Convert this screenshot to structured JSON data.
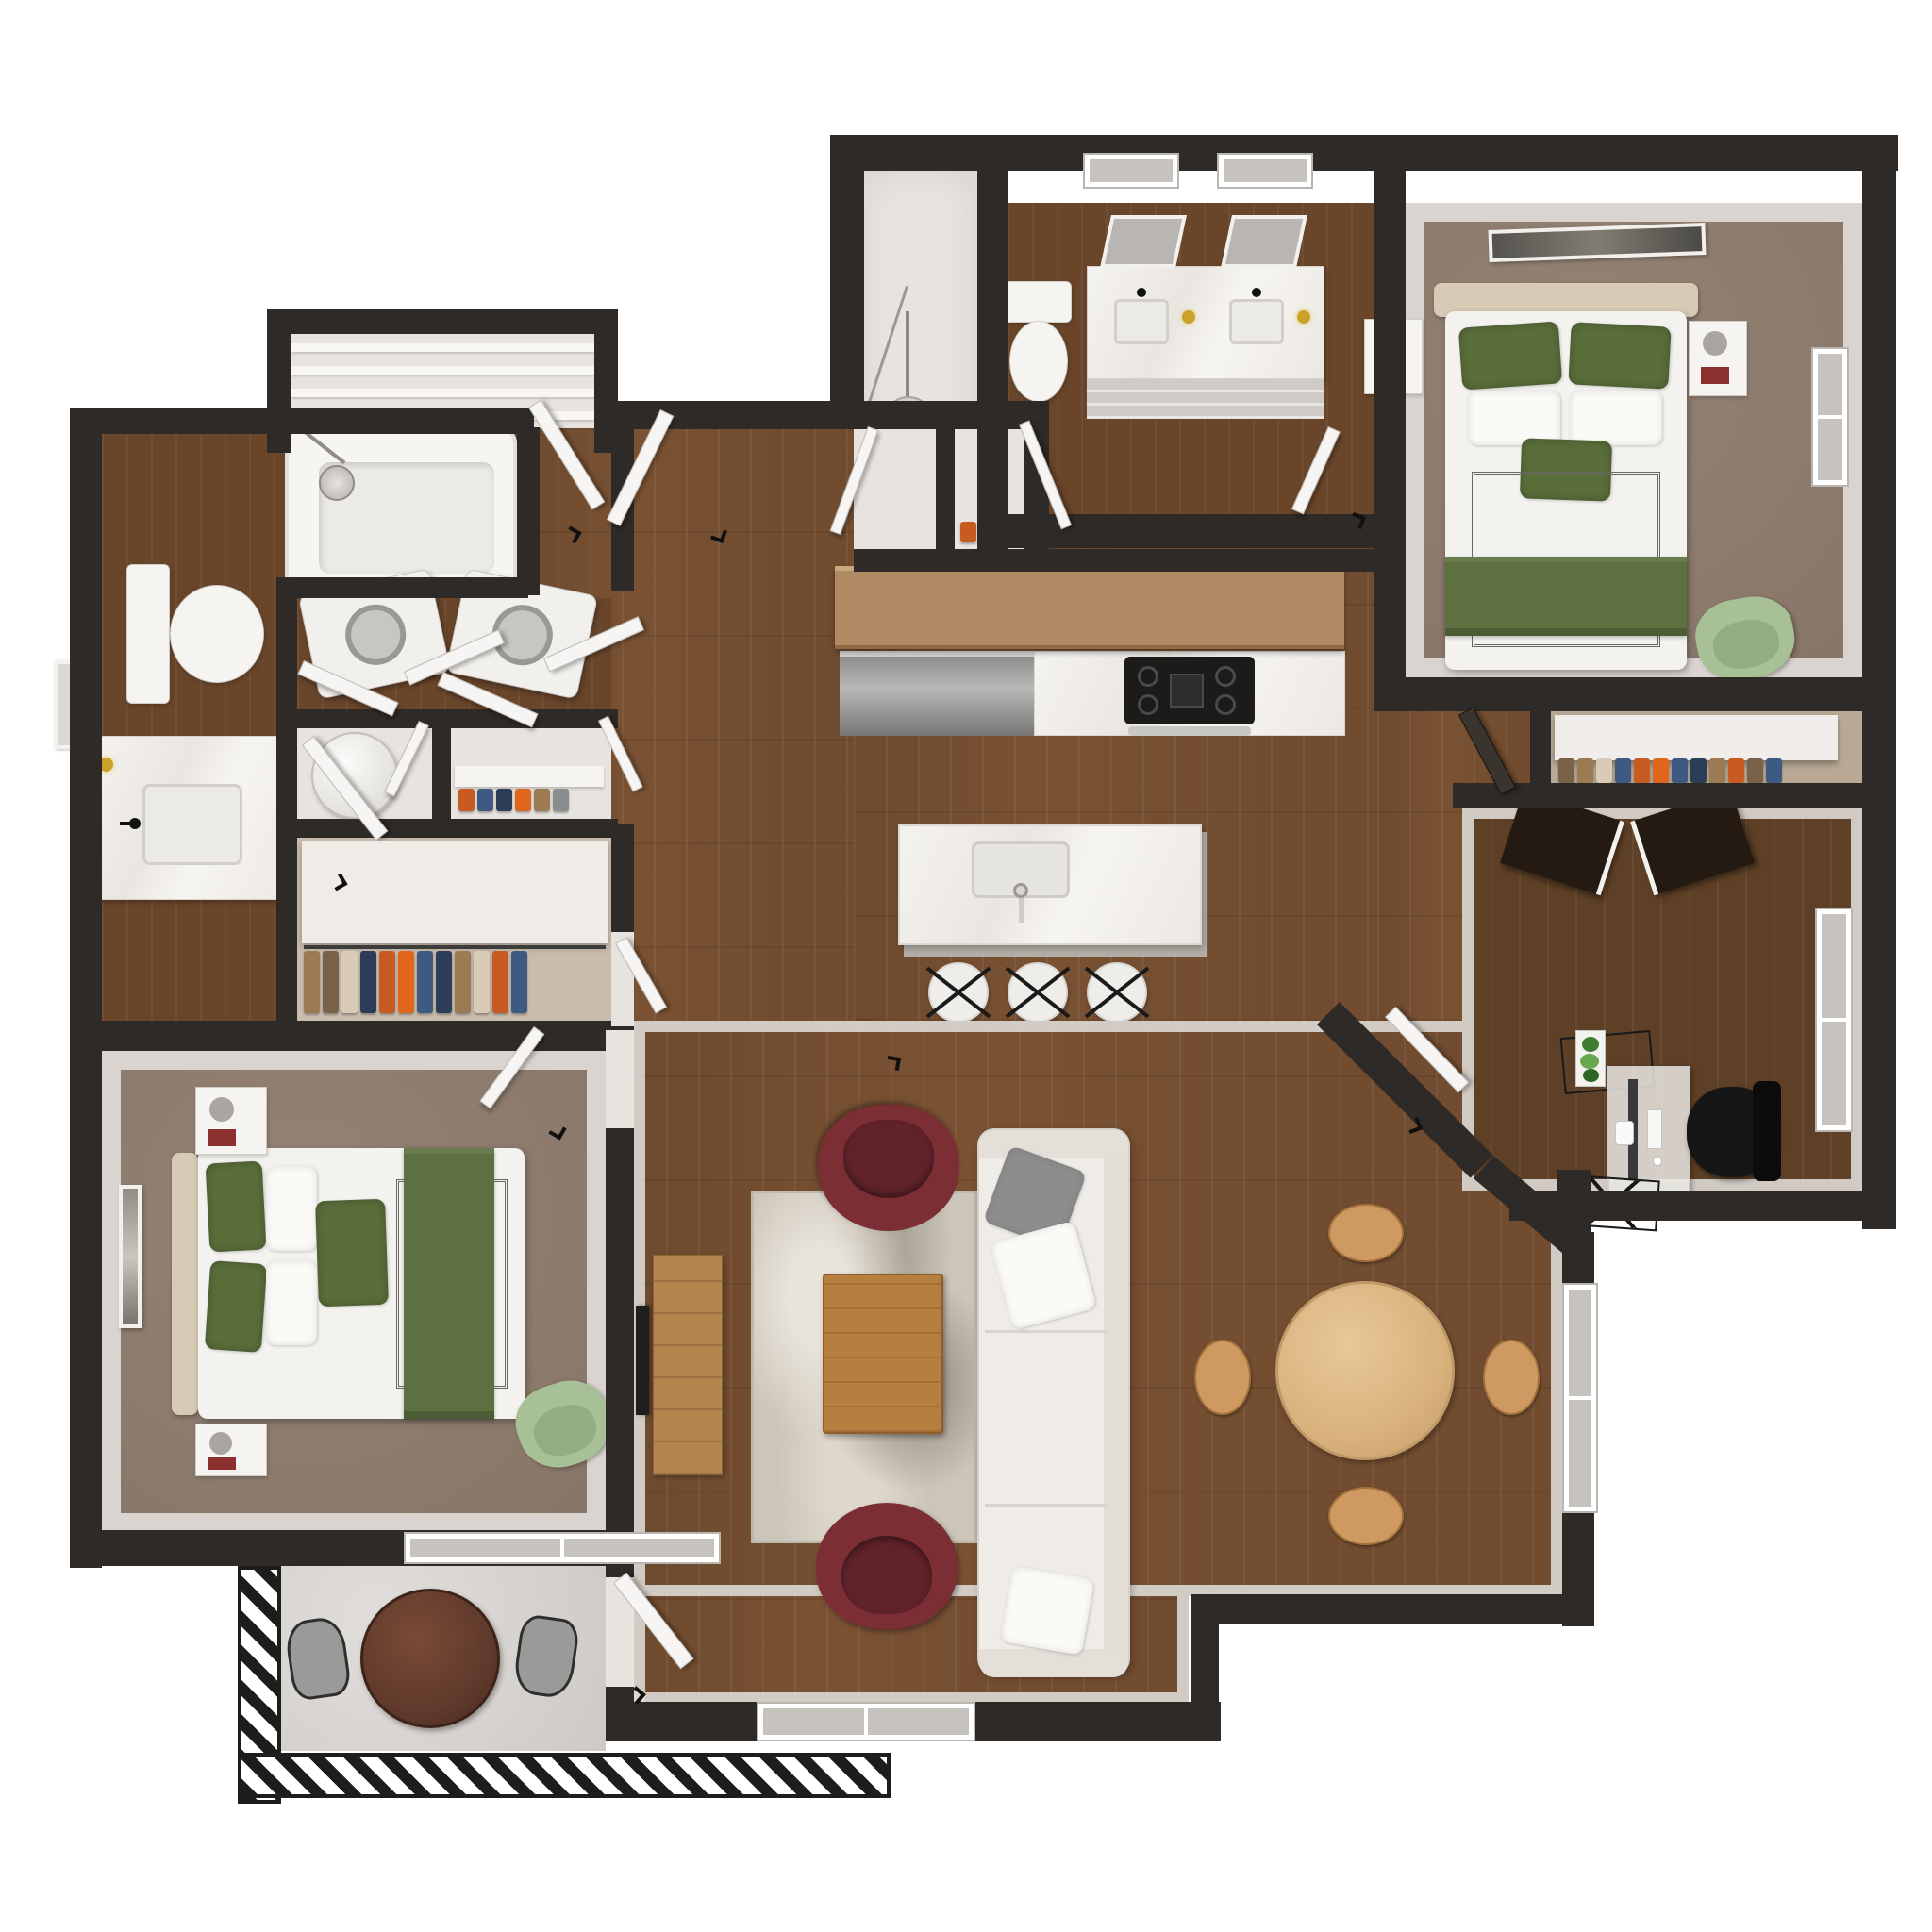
{
  "meta": {
    "title": "3D Apartment Floor Plan - Top-Down Render",
    "type": "floor-plan",
    "view": "top-down dollhouse",
    "style": "photorealistic 3D render, no text labels",
    "unit": "two-bedroom, two-bath apartment with den and balcony"
  },
  "colors": {
    "wall": "#2d2a27",
    "wood": "#7a5233",
    "wood_dark": "#69452a",
    "wood_office": "#5e4026",
    "carpet": "#8e7b6c",
    "carpet_light": "#c9bcae",
    "floor_light": "#e7e3df",
    "concrete": "#d6d2ce",
    "marble": "#f2efea",
    "green": "#5a6e3a",
    "green_throw": "#5d7140",
    "green_chair": "#a7c096",
    "burgundy": "#7b2e34",
    "rug": "#ccc5ba",
    "sofa": "#efece7",
    "bar_wood": "#b08a63",
    "table_wood": "#d9b27e",
    "chair_tan": "#cf9a62",
    "console_wood": "#b5854e",
    "coffee_wood": "#b77f3f",
    "walnut": "#5e392b",
    "clothes1": "#9c7b52",
    "clothes2": "#3f5a82",
    "clothes3": "#c75b22",
    "clothes4": "#2c3e57",
    "clothes5": "#7a6248",
    "clothes6": "#d9cbb8",
    "clothes7": "#e0661c",
    "clothes8": "#8a8d90"
  },
  "rooms": [
    {
      "id": "master-bedroom",
      "name": "Primary Bedroom",
      "floor": "taupe carpet",
      "furniture": [
        "upholstered bed with white duvet, green pillows and green throw",
        "two white nightstands with lamps and books",
        "sage green armchair",
        "framed art above bed",
        "window on east wall"
      ]
    },
    {
      "id": "master-bathroom",
      "name": "Primary Bathroom",
      "floor": "dark wood",
      "furniture": [
        "double-sink marble vanity with black faucets",
        "two wall mirrors",
        "two windows",
        "toilet",
        "gray tile runner"
      ]
    },
    {
      "id": "entry-nook",
      "name": "Entry Nook",
      "floor": "light",
      "furniture": [
        "arc floor lamp"
      ]
    },
    {
      "id": "suite-closet",
      "name": "Bedroom Closet",
      "floor": "carpet",
      "furniture": [
        "white shelf",
        "hanging clothes"
      ]
    },
    {
      "id": "office",
      "name": "Office / Den",
      "floor": "dark wood",
      "furniture": [
        "desk with monitor, keyboard, mouse and mini pc",
        "black office chair",
        "wire plant stand with plant",
        "wire storage basket",
        "two dark closet door panels",
        "window"
      ]
    },
    {
      "id": "kitchen",
      "name": "Kitchen",
      "floor": "wood",
      "furniture": [
        "wood breakfast bar",
        "stainless dishwasher",
        "marble counter with gas cooktop and oven handle",
        "marble island with undermount sink and faucet",
        "three white counter stools"
      ]
    },
    {
      "id": "dining-area",
      "name": "Dining Area",
      "floor": "wood",
      "furniture": [
        "round light-wood dining table",
        "four tan dining chairs",
        "window"
      ]
    },
    {
      "id": "living-room",
      "name": "Living Room",
      "floor": "wood",
      "furniture": [
        "white three-seat sofa with gray and white pillows",
        "two burgundy swivel chairs",
        "wood coffee table",
        "abstract gray area rug",
        "wood TV console with television",
        "front door",
        "window on south wall"
      ]
    },
    {
      "id": "hallway",
      "name": "Hallway",
      "floor": "wood",
      "furniture": [
        "open interior doors"
      ]
    },
    {
      "id": "laundry-closet",
      "name": "Laundry Closet",
      "floor": "dark wood",
      "furniture": [
        "washer",
        "dryer",
        "bi-fold doors"
      ]
    },
    {
      "id": "utility-closet",
      "name": "Utility Closet",
      "floor": "light",
      "furniture": [
        "water heater"
      ]
    },
    {
      "id": "shoe-closet",
      "name": "Shoe Closet",
      "floor": "light",
      "furniture": [
        "shoe shelf with colorful shoes"
      ]
    },
    {
      "id": "walk-in-closet",
      "name": "Walk-in Closet",
      "floor": "light carpet",
      "furniture": [
        "white shelving",
        "clothes rod with hanging clothes"
      ]
    },
    {
      "id": "linen-closet",
      "name": "Linen Closet",
      "floor": "light",
      "furniture": [
        "shelves"
      ]
    },
    {
      "id": "second-bathroom",
      "name": "Second Bathroom",
      "floor": "dark wood",
      "furniture": [
        "bathtub with shower fixture",
        "toilet",
        "marble vanity with sink, black faucet and gold sconce",
        "wall mirror"
      ]
    },
    {
      "id": "second-bedroom",
      "name": "Second Bedroom",
      "floor": "taupe carpet",
      "furniture": [
        "bed with white duvet, green pillows and green runner",
        "two white nightstands",
        "sage green armchair",
        "framed wall art",
        "window to balcony"
      ]
    },
    {
      "id": "balcony",
      "name": "Balcony",
      "floor": "concrete",
      "furniture": [
        "round walnut bistro table",
        "two gray patio chairs",
        "hatched black railing"
      ]
    }
  ]
}
